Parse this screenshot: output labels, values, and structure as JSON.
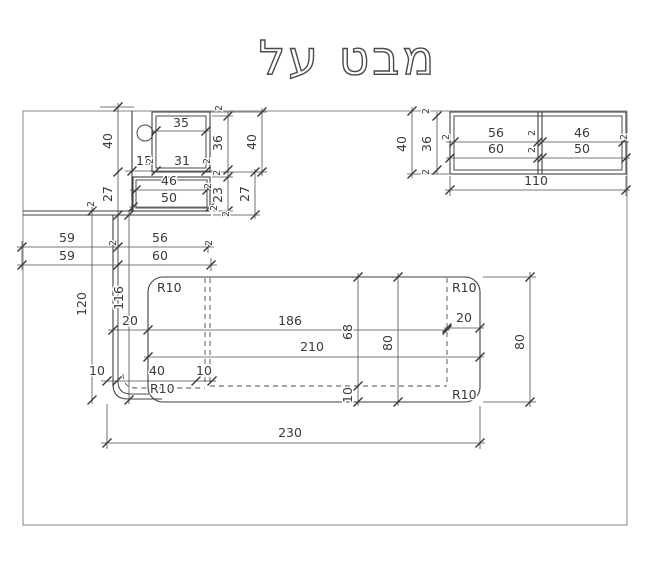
{
  "title": "מבט על",
  "dim_labels": {
    "d2": "2",
    "d10": "10",
    "d15": "15",
    "d20": "20",
    "d23": "23",
    "d27": "27",
    "d31": "31",
    "d35": "35",
    "d36": "36",
    "d40": "40",
    "d46": "46",
    "d50": "50",
    "d56": "56",
    "d59": "59",
    "d60": "60",
    "d68": "68",
    "d80": "80",
    "d110": "110",
    "d116": "116",
    "d120": "120",
    "d186": "186",
    "d210": "210",
    "d230": "230",
    "r10": "R10"
  }
}
